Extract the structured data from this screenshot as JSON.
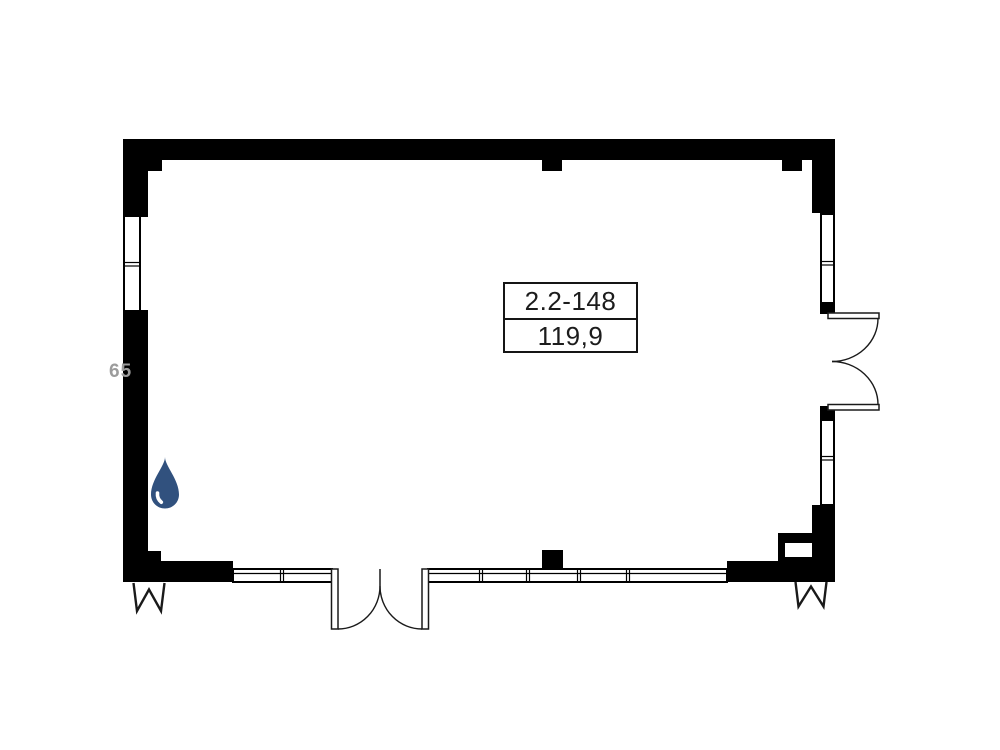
{
  "plan": {
    "unit_label": {
      "id": "2.2-148",
      "area": "119,9"
    },
    "watermark": "65",
    "colors": {
      "walls": "#000000",
      "water_drop": "#31517e",
      "line": "#1a1a1a",
      "watermark": "#9c9c9c",
      "background": "#ffffff"
    },
    "icons": {
      "water_drop": "water-drop-icon",
      "entrance_left": "entrance-arrow-icon",
      "entrance_right": "entrance-arrow-icon"
    }
  }
}
